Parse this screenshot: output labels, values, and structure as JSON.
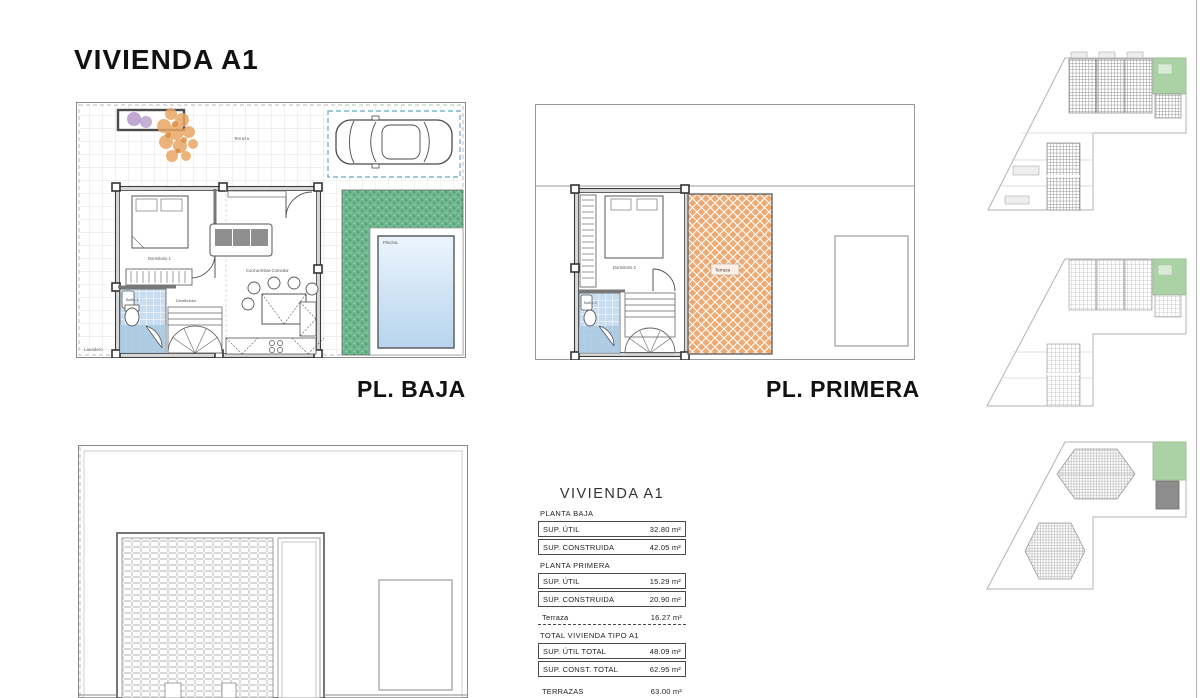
{
  "page": {
    "title": "VIVIENDA A1"
  },
  "ground_plan": {
    "label": "PL. BAJA",
    "rooms": {
      "terrace": "Terraza",
      "bedroom": "Dormitorio 1",
      "living": "Cocina-Estar-Comedor",
      "bath": "Baño 1",
      "hall": "Distribuidor",
      "laundry": "Lavadero",
      "pool": "Piscina"
    }
  },
  "first_plan": {
    "label": "PL. PRIMERA",
    "rooms": {
      "bedroom": "Dormitorio 2",
      "bath": "Baño 2",
      "hall": "Distribuidor 2",
      "terrace": "Terraza"
    }
  },
  "area_table": {
    "title": "VIVIENDA A1",
    "sections": [
      {
        "header": "PLANTA BAJA",
        "rows": [
          {
            "label": "SUP. ÚTIL",
            "value": "32.80 m²"
          },
          {
            "label": "SUP. CONSTRUIDA",
            "value": "42.05 m²"
          }
        ]
      },
      {
        "header": "PLANTA PRIMERA",
        "rows": [
          {
            "label": "SUP. ÚTIL",
            "value": "15.29 m²"
          },
          {
            "label": "SUP. CONSTRUIDA",
            "value": "20.90 m²"
          },
          {
            "label": "Terraza",
            "value": "16.27 m²"
          }
        ]
      },
      {
        "header": "TOTAL VIVIENDA TIPO A1",
        "rows": [
          {
            "label": "SUP. ÚTIL TOTAL",
            "value": "48.09 m²"
          },
          {
            "label": "SUP. CONST. TOTAL",
            "value": "62.95 m²"
          }
        ]
      },
      {
        "header": "",
        "rows": [
          {
            "label": "TERRAZAS",
            "value": "63.00 m²"
          },
          {
            "label": "PISCINA",
            "value": "9.50 m²"
          }
        ]
      }
    ]
  },
  "colors": {
    "lawn_green": "#6fb78e",
    "terrace_tile_orange": "#edaa72",
    "bath_tile_blue": "#c8def0",
    "pool_blue": "#bcd8f0",
    "highlight_green": "#abd2a4"
  }
}
